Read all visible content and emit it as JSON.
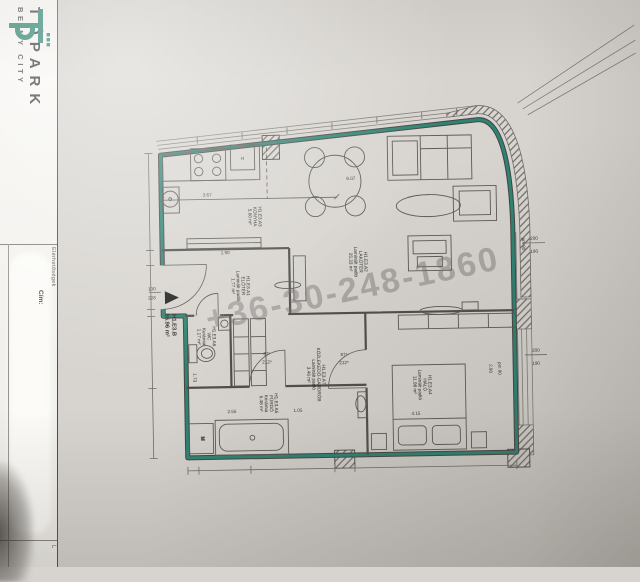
{
  "brand": {
    "name": "TÓPARK",
    "tagline": "BE MY CITY",
    "logo_color": "#2b8471"
  },
  "titleblock": {
    "contact_label": "Elérhetőségek",
    "address_label": "Cím:",
    "corner_label": "L"
  },
  "watermark": {
    "text": "+36-30-248-1860"
  },
  "colors": {
    "wall_teal": "#2e8374",
    "paper": "#d7d4cf",
    "ink": "#45453f"
  },
  "apartment": {
    "id": "H1.E3.B",
    "area": "65.96 m²"
  },
  "rooms": {
    "eloter": {
      "id": "H1.E3.A1",
      "name": "ELŐTÉR",
      "floor": "Laminált padló",
      "area": "1.77 m²"
    },
    "lakoter": {
      "id": "H1.E3.A2",
      "name": "LAKÓTÉR",
      "floor": "Laminált padló",
      "area": "25.33 m²"
    },
    "konyha": {
      "id": "H1.E3.A3",
      "name": "KONYHA",
      "area": "5.60 m²"
    },
    "halo": {
      "id": "H1.E3.A4",
      "name": "HÁLÓ",
      "floor": "Laminált padló",
      "area": "11.98 m²"
    },
    "furdo": {
      "id": "H1.E3.A5",
      "name": "FÜRDŐ",
      "floor": "Kerámia",
      "area": "6.48 m²"
    },
    "wc": {
      "id": "H1.E3.A6",
      "name": "WC",
      "floor": "Kerámia",
      "area": "1.17 m²"
    },
    "gardrob": {
      "id": "H1.E3.A7",
      "name": "KÖZLEKEDŐ-GARDRÓB",
      "floor": "Laminált padló",
      "area": "3.46 m²"
    }
  },
  "fixtures": {
    "fridge": "H",
    "washer": "M"
  },
  "dims": {
    "kitchen_w": "3.67",
    "counter": "1.90",
    "living": "6.07",
    "bath_w": "2.55",
    "bath_n": "1.05",
    "wc_h": "1.73",
    "bed_w": "4.15",
    "bed_h": "2.90",
    "win_top": "200",
    "win_bot": "190",
    "parapet": "pm 90",
    "entry_top": "100",
    "entry_bot": "228",
    "door_top": "87⁵",
    "door_bot": "212⁵"
  }
}
